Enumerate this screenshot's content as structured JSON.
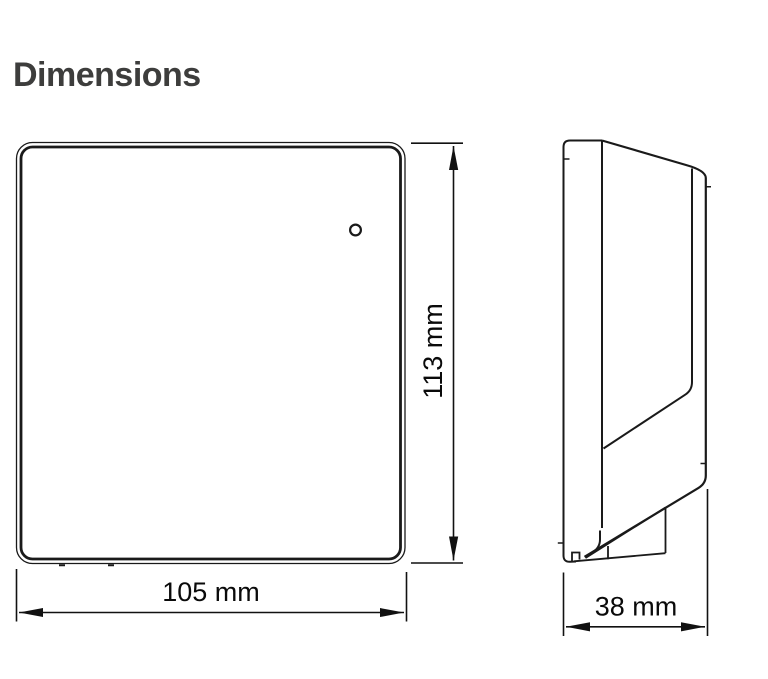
{
  "page": {
    "title": "Dimensions",
    "background_color": "#ffffff",
    "title_color": "#3d3d3c",
    "line_color": "#1a1a1a"
  },
  "drawing": {
    "front_view": {
      "name": "device front view",
      "features": [
        "rounded-square-housing",
        "double-frame-edge",
        "led-hole-top-right",
        "two-bottom-clip-nubs"
      ],
      "width": {
        "value": 105,
        "unit": "mm",
        "label": "105 mm"
      },
      "height": {
        "value": 113,
        "unit": "mm",
        "label": "113 mm"
      }
    },
    "side_view": {
      "name": "device side profile view",
      "features": [
        "wall-mounting-back-plate",
        "sloped-front-cover",
        "tapered-bottom",
        "bottom-clip-foot"
      ],
      "depth": {
        "value": 38,
        "unit": "mm",
        "label": "38 mm"
      }
    }
  }
}
